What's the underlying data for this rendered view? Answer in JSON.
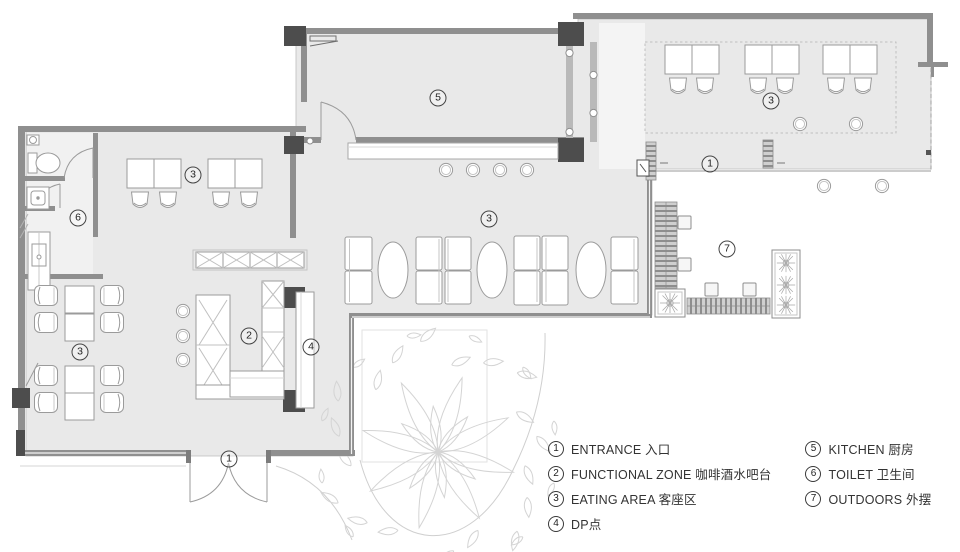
{
  "plan": {
    "markers": [
      {
        "label": "1",
        "x": 229,
        "y": 459
      },
      {
        "label": "1",
        "x": 710,
        "y": 164
      },
      {
        "label": "2",
        "x": 249,
        "y": 336
      },
      {
        "label": "3",
        "x": 193,
        "y": 175
      },
      {
        "label": "3",
        "x": 489,
        "y": 219
      },
      {
        "label": "3",
        "x": 80,
        "y": 352
      },
      {
        "label": "3",
        "x": 771,
        "y": 101
      },
      {
        "label": "4",
        "x": 311,
        "y": 347
      },
      {
        "label": "5",
        "x": 438,
        "y": 98
      },
      {
        "label": "6",
        "x": 78,
        "y": 218
      },
      {
        "label": "7",
        "x": 727,
        "y": 249
      }
    ]
  },
  "legend": {
    "col1": [
      {
        "num": "1",
        "text": "ENTRANCE 入口"
      },
      {
        "num": "2",
        "text": "FUNCTIONAL ZONE 咖啡酒水吧台"
      },
      {
        "num": "3",
        "text": "EATING AREA 客座区"
      },
      {
        "num": "4",
        "text": "DP点"
      }
    ],
    "col2": [
      {
        "num": "5",
        "text": "KITCHEN 厨房"
      },
      {
        "num": "6",
        "text": "TOILET 卫生间"
      },
      {
        "num": "7",
        "text": "OUTDOORS 外摆"
      }
    ]
  },
  "colors": {
    "floor": "#e9e9e9",
    "wall": "#8f8f8f",
    "column": "#4d4d4d",
    "furniture_line": "#9b9b9b",
    "tree_line": "#d4d4d4",
    "text": "#333333"
  }
}
